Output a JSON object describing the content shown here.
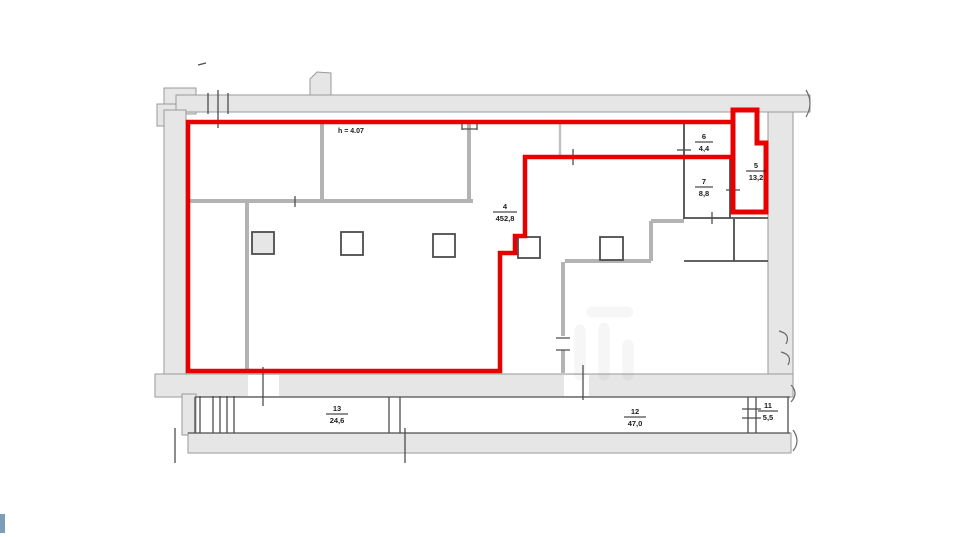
{
  "plan": {
    "height_note": "h = 4.07",
    "rooms": [
      {
        "id": "room-4",
        "number": "4",
        "area": "452,8"
      },
      {
        "id": "room-6",
        "number": "6",
        "area": "4,4"
      },
      {
        "id": "room-7",
        "number": "7",
        "area": "8,8"
      },
      {
        "id": "room-5",
        "number": "5",
        "area": "13,2"
      },
      {
        "id": "room-13",
        "number": "13",
        "area": "24,6"
      },
      {
        "id": "room-12",
        "number": "12",
        "area": "47,0"
      },
      {
        "id": "room-11",
        "number": "11",
        "area": "5,5"
      }
    ],
    "colors": {
      "background": "#ffffff",
      "highlight": "#e80000",
      "wall_fill": "#e6e6e6",
      "wall_edge": "#9a9a9a",
      "partition": "#b3b3b3",
      "dark": "#4d4d4d",
      "label": "#1c1c1c",
      "accent": "#7d9cb5"
    }
  }
}
